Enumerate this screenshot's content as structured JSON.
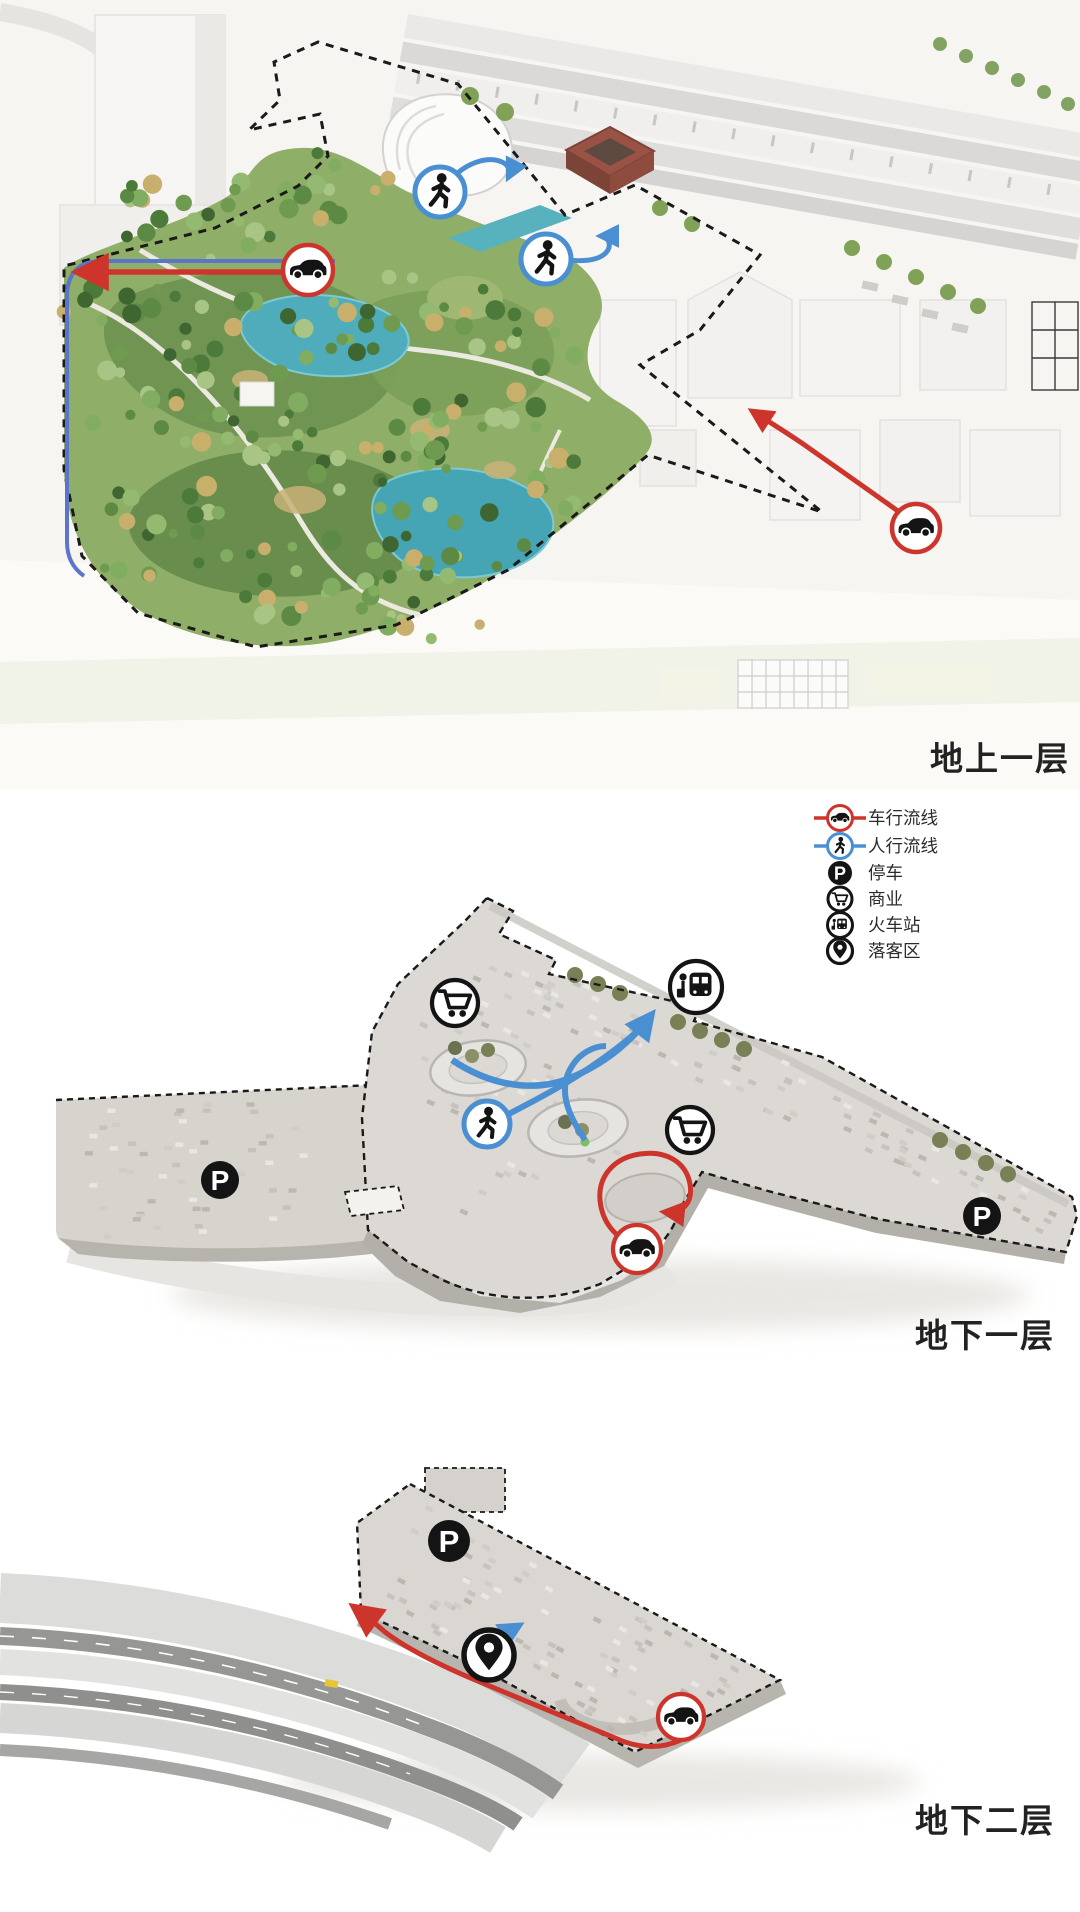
{
  "levels": {
    "ground": {
      "label": "地上一层"
    },
    "basement1": {
      "label": "地下一层"
    },
    "basement2": {
      "label": "地下二层"
    }
  },
  "legend": {
    "items": [
      {
        "name": "vehicle-circulation",
        "label": "车行流线",
        "color": "#cd352c"
      },
      {
        "name": "pedestrian-circulation",
        "label": "人行流线",
        "color": "#4a8fd2"
      },
      {
        "name": "parking",
        "label": "停车",
        "color": "#141414"
      },
      {
        "name": "retail",
        "label": "商业",
        "color": "#141414"
      },
      {
        "name": "train-station",
        "label": "火车站",
        "color": "#141414"
      },
      {
        "name": "drop-off",
        "label": "落客区",
        "color": "#141414"
      }
    ]
  },
  "icons": {
    "parking_letter": "P"
  },
  "colors": {
    "vehicle_route": "#cd352c",
    "pedestrian_route": "#4a8fd2",
    "icon_black": "#141414",
    "water": "#4aa9b7",
    "park_green": "#6e9350",
    "plan_gray": "#dcd9d4",
    "background": "#f7f5f2"
  }
}
